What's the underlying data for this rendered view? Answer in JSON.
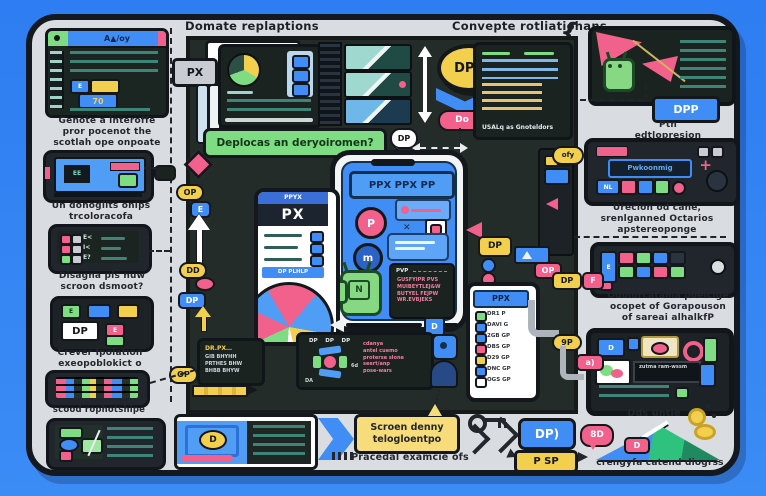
{
  "colors": {
    "background_blue": "#2f80f2",
    "canvas_gray": "#d9dce1",
    "center_dark": "#242c29",
    "panel_dark": "#1b2321",
    "accent_blue": "#3f8df5",
    "accent_pink": "#f2608c",
    "accent_green": "#7edc82",
    "accent_yellow": "#f3cf4e",
    "teal_line": "#3f8577",
    "ink": "#14181d"
  },
  "headings": {
    "left": "Domate replaptions",
    "right": "Convepte rotliatiohans",
    "brace": "{"
  },
  "left_column": {
    "browser": {
      "title": "A▲/oy",
      "btn_e": "E",
      "btn_70": "70"
    },
    "caption_browser": "Genote a interoffe\npror pocenot the\nscotlah ope onpoate",
    "tablet_label": "EE",
    "caption_tablet": "Un donoglits onips\ntrcoloracofa",
    "row_texts": {
      "r1": "E<",
      "r2": "I<",
      "r3": "E?"
    },
    "caption_rows": "Disagna pls nuw\nscroon dsmoot?",
    "dp_label": "DP",
    "chip_green": "E",
    "chip_pink": "E",
    "caption_dp": "Crever Ipolation\nexeopoblokict o",
    "caption_pixel": "scood rophotshipe"
  },
  "divider": {
    "op_pill": "OP",
    "e_tag": "E",
    "dd_pill": "DD",
    "dp_tag": "DP",
    "op_speech": "OP"
  },
  "center": {
    "px_pp_label": "PX PPy",
    "px_tag": "PX",
    "deploy_banner": "Deplocas an deryoiromen?",
    "dpp_oval": "DPP",
    "do_pill": "Do",
    "dp_circle": "DP",
    "bullet_footer": "USALq as Gnoteldors",
    "phone_header": "PPX PPX PP",
    "p_circle": "P",
    "m_circle": "m",
    "android_letter": "N",
    "code_header": "PVP",
    "code_lines": "GUSFYIPR PVS\nMUIBEYTLEJ&W\nBUTYEL FEJPW\nWR.EVBJEKS",
    "wphone_h1": "PPYX",
    "wphone_h2": "PX",
    "wphone_row": "DP PLHLP",
    "slider_handle": "D",
    "hex_top": "DP    DP    DP",
    "hex_da": "DA",
    "hex_6d": "6d",
    "hex_code": "cdanya\nantel cuemo\nproterse slone\nseert/anp\npose-wars",
    "card_title": "DR.PX…",
    "card_lines": "GIB BHYHH\nPRTHES BHW\nBHBB BHYW",
    "dp_yellow": "DP",
    "op_pink": "OP",
    "b_icon": "B",
    "d_tag": "D",
    "list_phone": {
      "header": "PPX",
      "rows": [
        {
          "t": "DR1 P"
        },
        {
          "t": "DAVI G"
        },
        {
          "t": "2GB GP"
        },
        {
          "t": "DBS GP"
        },
        {
          "t": "D29 GP"
        },
        {
          "t": "DNC GP"
        },
        {
          "t": "OGS GP"
        }
      ]
    }
  },
  "right_column": {
    "dpp_button": "DPP",
    "caption_dpp": "Ptn\nedtlopresion",
    "ofy_tag": "ofy",
    "player_bar": "Pwkoonmig",
    "plus": "+",
    "nl_chip": "NL",
    "caption_mid": "Urecion od cane,\nsrenlganned Octarios\napstereoponge",
    "e_side": "E",
    "dp_tag": "DP",
    "flag": "F",
    "caption_compare": "Odolorcatama poelcige\nocopet of Gorapouson\nof sareai alhalkfP",
    "tablet_d": "D",
    "tablet_bar": "zutma ram-wssm",
    "pill_9p": "9P",
    "tag_a": "a)",
    "dds_units": "Dds untle",
    "mountain_tag": "D",
    "caption_mountain": "crengyfa catend diogrss"
  },
  "bottom": {
    "card_d": "D",
    "bubble": "Scroen denny\ntelogloentpo",
    "practical": "Pracedal examcie ofs",
    "dp_button": "DP)",
    "psp_button": "P SP",
    "sd_bubble": "8D"
  }
}
